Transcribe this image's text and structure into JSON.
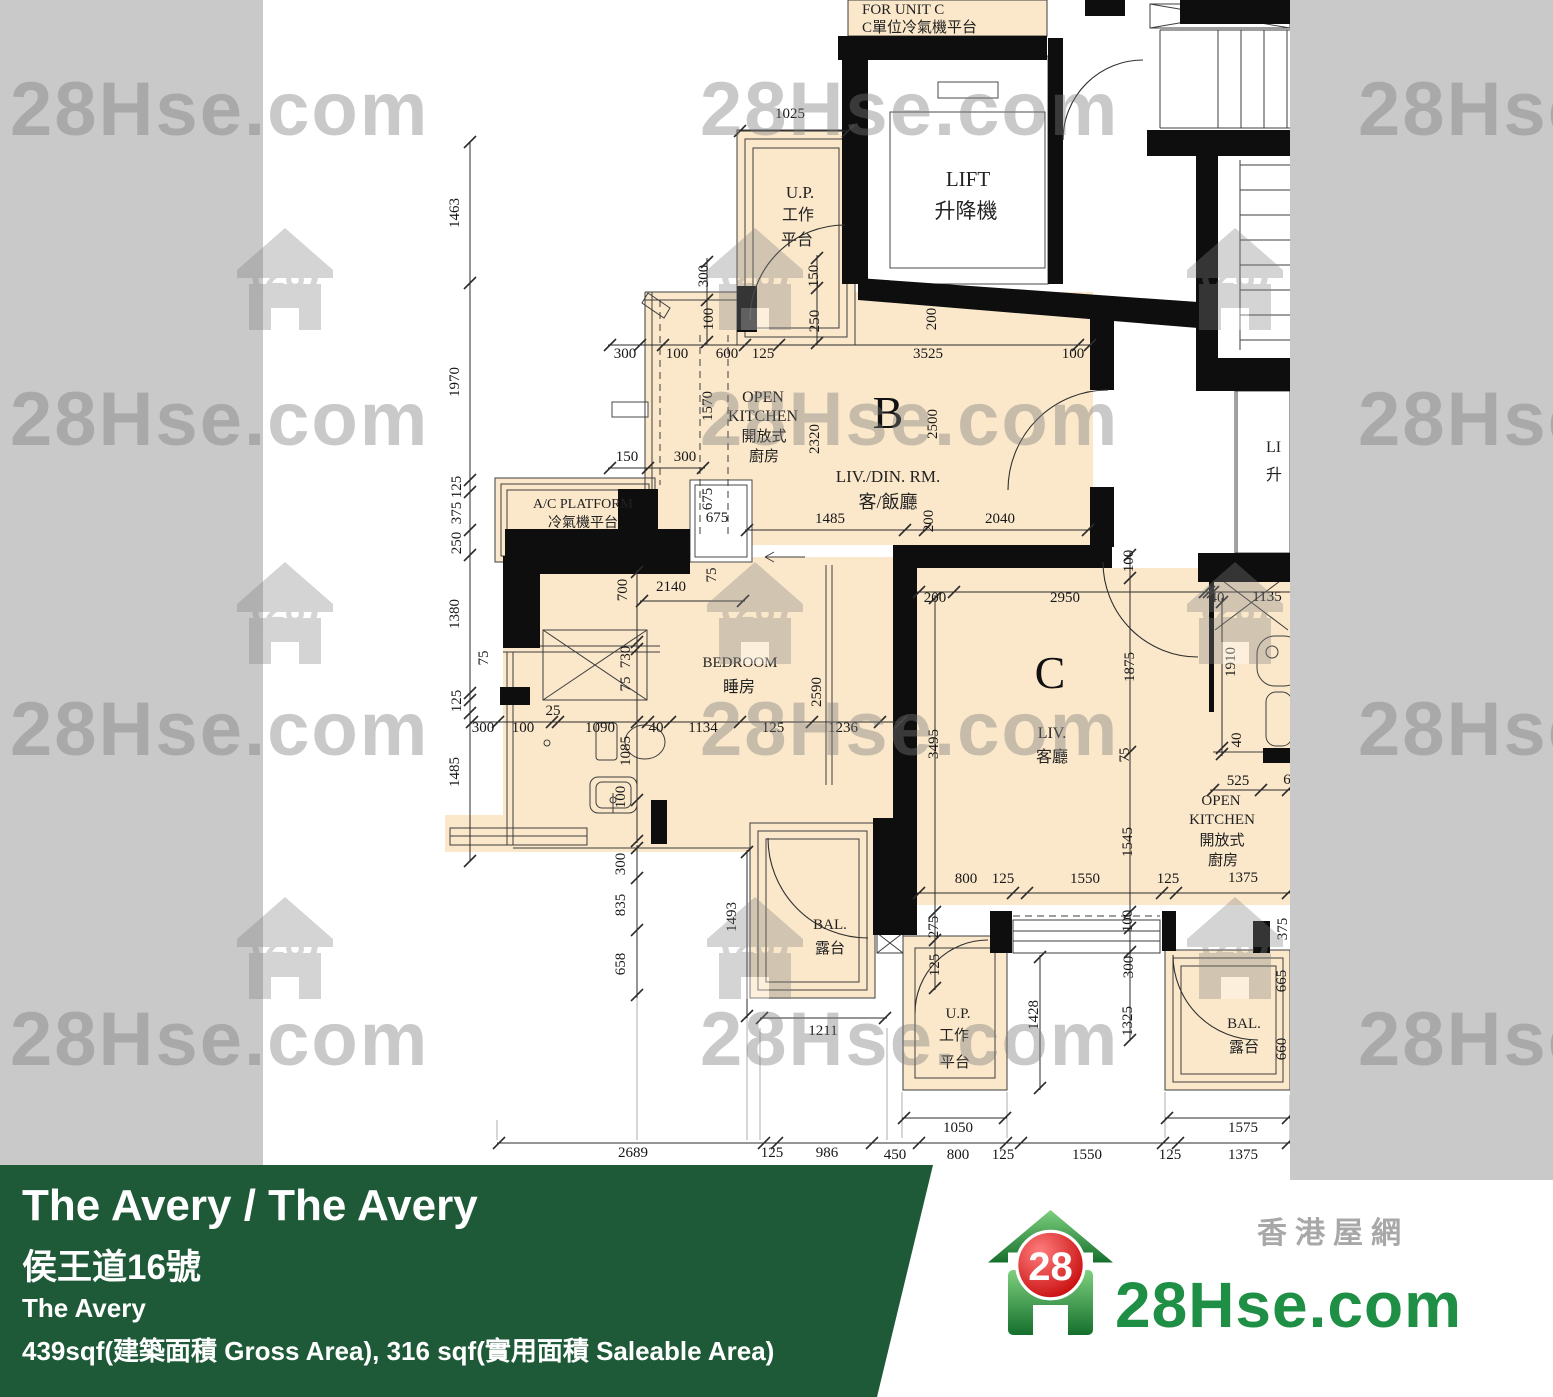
{
  "banner": {
    "title": "The Avery / The Avery",
    "address_zh": "侯王道16號",
    "name_en": "The Avery",
    "area_text": "439sqf(建築面積 Gross Area), 316 sqf(實用面積 Saleable Area)"
  },
  "logo": {
    "brand": "28Hse.com",
    "tagline": "香港屋網",
    "badge": "28"
  },
  "watermark": {
    "text": "28Hse.com",
    "badge": "28",
    "text_positions": [
      {
        "x": 10,
        "y": 135
      },
      {
        "x": 700,
        "y": 135
      },
      {
        "x": 1358,
        "y": 135
      },
      {
        "x": 10,
        "y": 445
      },
      {
        "x": 700,
        "y": 445
      },
      {
        "x": 1358,
        "y": 445
      },
      {
        "x": 10,
        "y": 755
      },
      {
        "x": 700,
        "y": 755
      },
      {
        "x": 1358,
        "y": 755
      },
      {
        "x": 10,
        "y": 1065
      },
      {
        "x": 700,
        "y": 1065
      },
      {
        "x": 1358,
        "y": 1065
      }
    ],
    "logo_positions": [
      {
        "x": 237,
        "y": 228
      },
      {
        "x": 707,
        "y": 228
      },
      {
        "x": 1187,
        "y": 228
      },
      {
        "x": 237,
        "y": 562
      },
      {
        "x": 707,
        "y": 562
      },
      {
        "x": 1187,
        "y": 562
      },
      {
        "x": 237,
        "y": 897
      },
      {
        "x": 707,
        "y": 897
      },
      {
        "x": 1187,
        "y": 897
      }
    ]
  },
  "colors": {
    "banner_green": "#1e5a37",
    "beige": "#fbe8cb",
    "gray_bg": "#c9c9c9",
    "wall_black": "#0e0e0e",
    "logo_green": "#1f8f45",
    "logo_red": "#d21313",
    "watermark_gray": "#7a7a7a"
  },
  "floorplan": {
    "unit_labels": [
      {
        "t": "B",
        "x": 888,
        "y": 428,
        "s": 46
      },
      {
        "t": "C",
        "x": 1050,
        "y": 688,
        "s": 46
      }
    ],
    "labels": [
      {
        "t": "FOR UNIT C",
        "x": 862,
        "y": 14,
        "s": 15,
        "a": "s"
      },
      {
        "t": "C單位冷氣機平台",
        "x": 862,
        "y": 32,
        "s": 15,
        "a": "s"
      },
      {
        "t": "LIFT",
        "x": 968,
        "y": 186,
        "s": 21
      },
      {
        "t": "升降機",
        "x": 966,
        "y": 218,
        "s": 21
      },
      {
        "t": "U.P.",
        "x": 800,
        "y": 198,
        "s": 17
      },
      {
        "t": "工作",
        "x": 798,
        "y": 220,
        "s": 16
      },
      {
        "t": "平台",
        "x": 797,
        "y": 245,
        "s": 16
      },
      {
        "t": "A/C PLATFORM",
        "x": 583,
        "y": 508,
        "s": 14
      },
      {
        "t": "冷氣機平台",
        "x": 583,
        "y": 527,
        "s": 14
      },
      {
        "t": "OPEN",
        "x": 763,
        "y": 402,
        "s": 16
      },
      {
        "t": "KITCHEN",
        "x": 763,
        "y": 421,
        "s": 16
      },
      {
        "t": "開放式",
        "x": 764,
        "y": 441,
        "s": 15
      },
      {
        "t": "廚房",
        "x": 764,
        "y": 461,
        "s": 15
      },
      {
        "t": "LIV./DIN. RM.",
        "x": 888,
        "y": 482,
        "s": 17
      },
      {
        "t": "客/飯廳",
        "x": 888,
        "y": 508,
        "s": 18
      },
      {
        "t": "BEDROOM",
        "x": 740,
        "y": 667,
        "s": 15
      },
      {
        "t": "睡房",
        "x": 739,
        "y": 692,
        "s": 16
      },
      {
        "t": "BAL.",
        "x": 830,
        "y": 929,
        "s": 15
      },
      {
        "t": "露台",
        "x": 830,
        "y": 953,
        "s": 15
      },
      {
        "t": "LIV.",
        "x": 1052,
        "y": 738,
        "s": 16
      },
      {
        "t": "客廳",
        "x": 1052,
        "y": 762,
        "s": 16
      },
      {
        "t": "OPEN",
        "x": 1221,
        "y": 805,
        "s": 15
      },
      {
        "t": "KITCHEN",
        "x": 1222,
        "y": 824,
        "s": 15
      },
      {
        "t": "開放式",
        "x": 1222,
        "y": 845,
        "s": 15
      },
      {
        "t": "廚房",
        "x": 1223,
        "y": 865,
        "s": 15
      },
      {
        "t": "U.P.",
        "x": 958,
        "y": 1018,
        "s": 15
      },
      {
        "t": "工作",
        "x": 954,
        "y": 1040,
        "s": 15
      },
      {
        "t": "平台",
        "x": 955,
        "y": 1067,
        "s": 15
      },
      {
        "t": "BAL.",
        "x": 1244,
        "y": 1028,
        "s": 15
      },
      {
        "t": "露台",
        "x": 1244,
        "y": 1052,
        "s": 15
      },
      {
        "t": "LI",
        "x": 1266,
        "y": 452,
        "s": 16,
        "a": "s"
      },
      {
        "t": "升",
        "x": 1266,
        "y": 480,
        "s": 16,
        "a": "s"
      }
    ],
    "dimensions": [
      {
        "t": "1025",
        "x": 790,
        "y": 118
      },
      {
        "t": "1463",
        "x": 459,
        "y": 213,
        "r": -90
      },
      {
        "t": "1970",
        "x": 459,
        "y": 382,
        "r": -90
      },
      {
        "t": "125",
        "x": 461,
        "y": 487,
        "r": -90
      },
      {
        "t": "375",
        "x": 461,
        "y": 513,
        "r": -90
      },
      {
        "t": "250",
        "x": 461,
        "y": 543,
        "r": -90
      },
      {
        "t": "1380",
        "x": 459,
        "y": 614,
        "r": -90
      },
      {
        "t": "75",
        "x": 488,
        "y": 658,
        "r": -90
      },
      {
        "t": "125",
        "x": 461,
        "y": 701,
        "r": -90
      },
      {
        "t": "1485",
        "x": 459,
        "y": 772,
        "r": -90
      },
      {
        "t": "300",
        "x": 708,
        "y": 276,
        "r": -90
      },
      {
        "t": "100",
        "x": 713,
        "y": 319,
        "r": -90
      },
      {
        "t": "150",
        "x": 818,
        "y": 276,
        "r": -90
      },
      {
        "t": "250",
        "x": 819,
        "y": 321,
        "r": -90
      },
      {
        "t": "200",
        "x": 936,
        "y": 319,
        "r": -90
      },
      {
        "t": "300",
        "x": 625,
        "y": 358
      },
      {
        "t": "100",
        "x": 677,
        "y": 358
      },
      {
        "t": "600",
        "x": 727,
        "y": 358
      },
      {
        "t": "125",
        "x": 763,
        "y": 358
      },
      {
        "t": "3525",
        "x": 928,
        "y": 358
      },
      {
        "t": "100",
        "x": 1073,
        "y": 358
      },
      {
        "t": "1570",
        "x": 712,
        "y": 406,
        "r": -90
      },
      {
        "t": "2320",
        "x": 819,
        "y": 439,
        "r": -90
      },
      {
        "t": "2500",
        "x": 937,
        "y": 424,
        "r": -90
      },
      {
        "t": "150",
        "x": 627,
        "y": 461
      },
      {
        "t": "300",
        "x": 685,
        "y": 461
      },
      {
        "t": "675",
        "x": 712,
        "y": 499,
        "r": -90
      },
      {
        "t": "675",
        "x": 717,
        "y": 522
      },
      {
        "t": "1485",
        "x": 830,
        "y": 523
      },
      {
        "t": "200",
        "x": 933,
        "y": 521,
        "r": -90
      },
      {
        "t": "2040",
        "x": 1000,
        "y": 523
      },
      {
        "t": "700",
        "x": 627,
        "y": 590,
        "r": -90
      },
      {
        "t": "2140",
        "x": 671,
        "y": 591
      },
      {
        "t": "75",
        "x": 716,
        "y": 575,
        "r": -90
      },
      {
        "t": "730",
        "x": 630,
        "y": 657,
        "r": -90
      },
      {
        "t": "75",
        "x": 630,
        "y": 684,
        "r": -90
      },
      {
        "t": "2590",
        "x": 821,
        "y": 692,
        "r": -90
      },
      {
        "t": "300",
        "x": 483,
        "y": 732
      },
      {
        "t": "100",
        "x": 523,
        "y": 732
      },
      {
        "t": "25",
        "x": 553,
        "y": 715
      },
      {
        "t": "1090",
        "x": 600,
        "y": 732
      },
      {
        "t": "1085",
        "x": 630,
        "y": 751,
        "r": -90
      },
      {
        "t": "40",
        "x": 656,
        "y": 732
      },
      {
        "t": "1134",
        "x": 703,
        "y": 732
      },
      {
        "t": "125",
        "x": 773,
        "y": 732
      },
      {
        "t": "1236",
        "x": 843,
        "y": 732
      },
      {
        "t": "100",
        "x": 625,
        "y": 797,
        "r": -90
      },
      {
        "t": "300",
        "x": 625,
        "y": 864,
        "r": -90
      },
      {
        "t": "835",
        "x": 625,
        "y": 905,
        "r": -90
      },
      {
        "t": "658",
        "x": 625,
        "y": 964,
        "r": -90
      },
      {
        "t": "1493",
        "x": 736,
        "y": 917,
        "r": -90
      },
      {
        "t": "1211",
        "x": 823,
        "y": 1035
      },
      {
        "t": "200",
        "x": 935,
        "y": 602
      },
      {
        "t": "2950",
        "x": 1065,
        "y": 602
      },
      {
        "t": "100",
        "x": 1133,
        "y": 561,
        "r": -90
      },
      {
        "t": "1875",
        "x": 1134,
        "y": 667,
        "r": -90
      },
      {
        "t": "3495",
        "x": 938,
        "y": 744,
        "r": -90
      },
      {
        "t": "75",
        "x": 1129,
        "y": 755,
        "r": -90
      },
      {
        "t": "1545",
        "x": 1132,
        "y": 842,
        "r": -90
      },
      {
        "t": "40",
        "x": 1217,
        "y": 602
      },
      {
        "t": "1135",
        "x": 1267,
        "y": 601
      },
      {
        "t": "1910",
        "x": 1235,
        "y": 662,
        "r": -90
      },
      {
        "t": "40",
        "x": 1241,
        "y": 740,
        "r": -90
      },
      {
        "t": "525",
        "x": 1238,
        "y": 785
      },
      {
        "t": "6",
        "x": 1287,
        "y": 784
      },
      {
        "t": "800",
        "x": 966,
        "y": 883
      },
      {
        "t": "125",
        "x": 1003,
        "y": 883
      },
      {
        "t": "1550",
        "x": 1085,
        "y": 883
      },
      {
        "t": "125",
        "x": 1168,
        "y": 883
      },
      {
        "t": "1375",
        "x": 1243,
        "y": 882
      },
      {
        "t": "100",
        "x": 1132,
        "y": 921,
        "r": -90
      },
      {
        "t": "275",
        "x": 938,
        "y": 927,
        "r": -90
      },
      {
        "t": "125",
        "x": 939,
        "y": 965,
        "r": -90
      },
      {
        "t": "300",
        "x": 1133,
        "y": 967,
        "r": -90
      },
      {
        "t": "1325",
        "x": 1132,
        "y": 1021,
        "r": -90
      },
      {
        "t": "1428",
        "x": 1038,
        "y": 1015,
        "r": -90
      },
      {
        "t": "375",
        "x": 1287,
        "y": 929,
        "r": -90
      },
      {
        "t": "665",
        "x": 1286,
        "y": 981,
        "r": -90
      },
      {
        "t": "660",
        "x": 1286,
        "y": 1049,
        "r": -90
      },
      {
        "t": "1050",
        "x": 958,
        "y": 1132
      },
      {
        "t": "1575",
        "x": 1243,
        "y": 1132
      },
      {
        "t": "2689",
        "x": 633,
        "y": 1157
      },
      {
        "t": "125",
        "x": 772,
        "y": 1157
      },
      {
        "t": "986",
        "x": 827,
        "y": 1157
      },
      {
        "t": "450",
        "x": 895,
        "y": 1159
      },
      {
        "t": "800",
        "x": 958,
        "y": 1159
      },
      {
        "t": "125",
        "x": 1003,
        "y": 1159
      },
      {
        "t": "1550",
        "x": 1087,
        "y": 1159
      },
      {
        "t": "125",
        "x": 1170,
        "y": 1159
      },
      {
        "t": "1375",
        "x": 1243,
        "y": 1159
      }
    ]
  }
}
